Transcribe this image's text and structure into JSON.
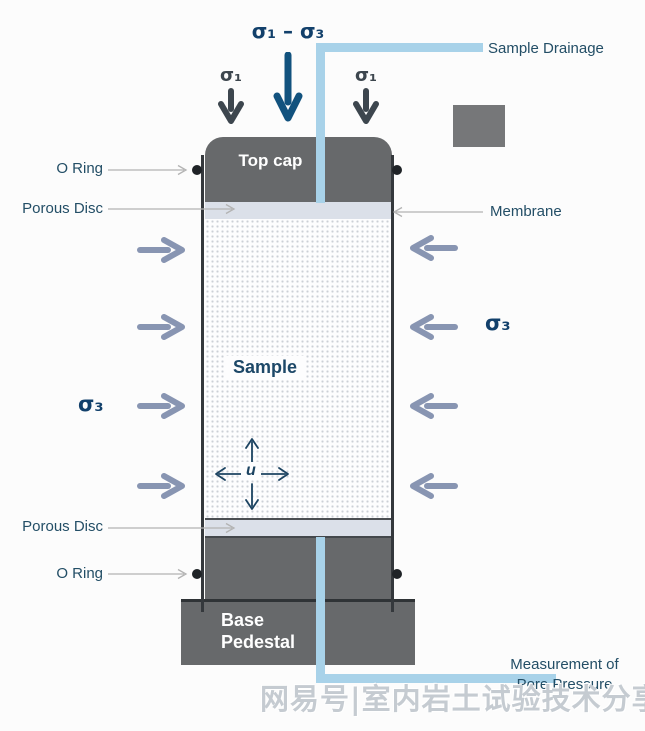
{
  "top": {
    "deviator_label": "σ₁ – σ₃",
    "axial_left": "σ₁",
    "axial_right": "σ₁",
    "drainage_label": "Sample Drainage"
  },
  "side_labels": {
    "o_ring_top": "O Ring",
    "porous_disc_top": "Porous Disc",
    "membrane": "Membrane",
    "sigma3_left": "σ₃",
    "sigma3_right": "σ₃",
    "porous_disc_bottom": "Porous Disc",
    "o_ring_bottom": "O Ring"
  },
  "cylinder": {
    "top_cap": "Top cap",
    "sample": "Sample",
    "pore_pressure_symbol": "u",
    "base_pedestal": "Base Pedestal"
  },
  "bottom": {
    "measurement_line1": "Measurement of",
    "measurement_line2": "Pore Pressure"
  },
  "watermark": {
    "text": "网易号|室内岩土试验技术分享"
  },
  "colors": {
    "cap_gray": "#67696b",
    "porous_disc": "#dbe0e9",
    "tube_blue": "#a8d2e9",
    "navy": "#12406b",
    "steel_arrow": "#8895b2",
    "charcoal_arrow": "#3d464e",
    "label_teal": "#234e66",
    "watermark_gray": "#c5cbd1"
  }
}
